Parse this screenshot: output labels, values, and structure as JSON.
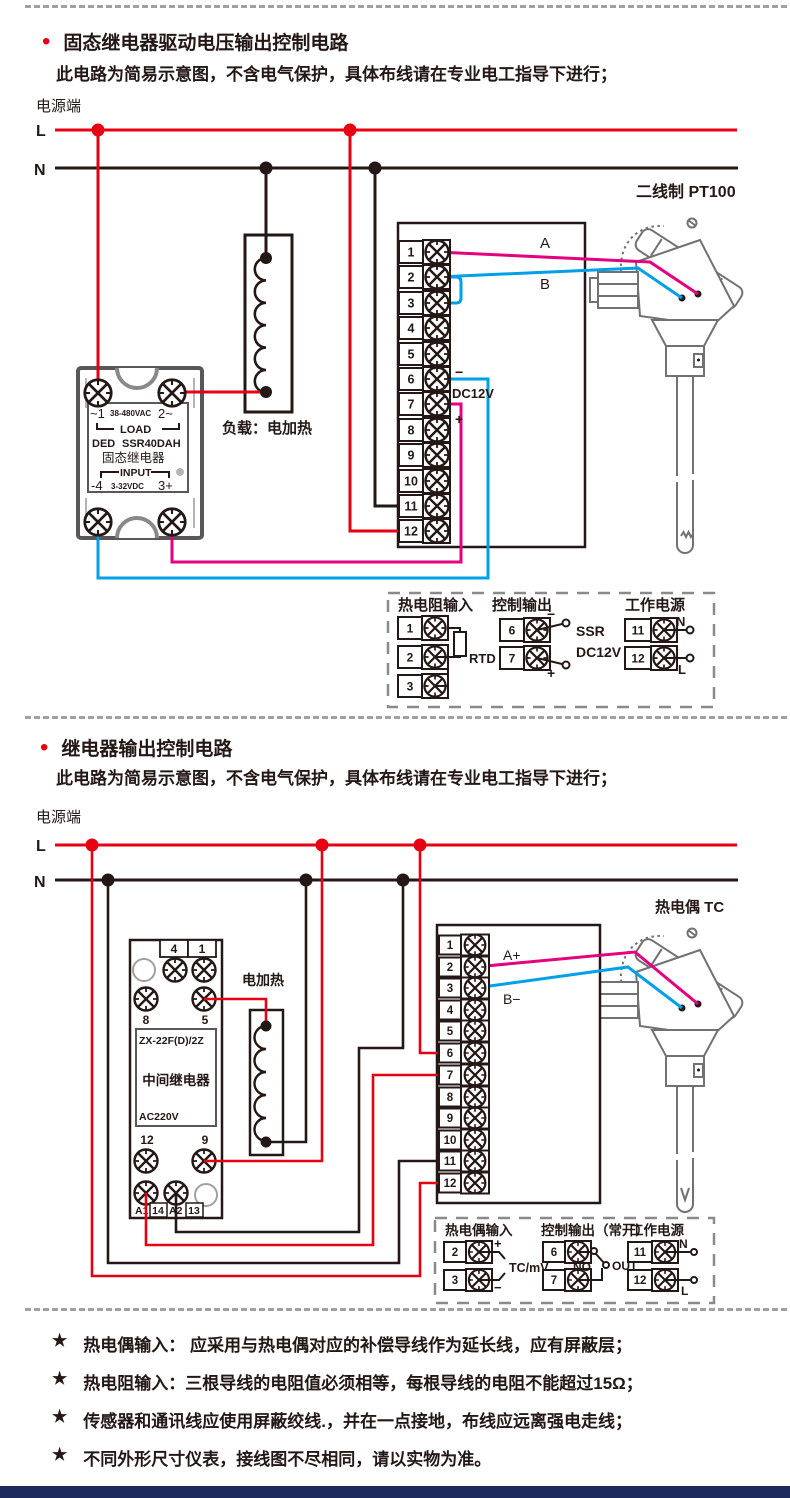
{
  "colors": {
    "wire_live": "#e60012",
    "wire_neutral": "#231815",
    "wire_blue": "#00a0e9",
    "wire_magenta": "#e4007f",
    "component_gray": "#727171",
    "footer_bar": "#1c2b5c"
  },
  "section1": {
    "bullet": "•",
    "title": "固态继电器驱动电压输出控制电路",
    "subtitle": "此电路为简易示意图，不含电气保护，具体布线请在专业电工指导下进行；",
    "power_label": "电源端",
    "live_label": "L",
    "neutral_label": "N",
    "ssr": {
      "pin1": "~1",
      "vac": "38-480VAC",
      "pin2": "2~",
      "load": "LOAD",
      "brand": "DED",
      "model": "SSR40DAH",
      "name": "固态继电器",
      "input": "INPUT",
      "pin4": "-4",
      "vdc": "3-32VDC",
      "pin3": "3+"
    },
    "load_label": "负载：电加热",
    "sensor_label": "二线制 PT100",
    "terminals": [
      "1",
      "2",
      "3",
      "4",
      "5",
      "6",
      "7",
      "8",
      "9",
      "10",
      "11",
      "12"
    ],
    "wire_a_label": "A",
    "wire_b_label": "B",
    "out_minus": "−",
    "out_dc": "DC12V",
    "out_plus": "+",
    "legend": {
      "rtd_title": "热电阻输入",
      "rtd_terminals": [
        "1",
        "2",
        "3"
      ],
      "rtd_label": "RTD",
      "out_title": "控制输出",
      "out_terminals": [
        "6",
        "7"
      ],
      "out_minus": "−",
      "out_plus": "+",
      "out_ssr": "SSR",
      "out_dc": "DC12V",
      "pwr_title": "工作电源",
      "pwr_terminals": [
        "11",
        "12"
      ],
      "pwr_n": "N",
      "pwr_l": "L"
    }
  },
  "section2": {
    "bullet": "•",
    "title": "继电器输出控制电路",
    "subtitle": "此电路为简易示意图，不含电气保护，具体布线请在专业电工指导下进行；",
    "power_label": "电源端",
    "live_label": "L",
    "neutral_label": "N",
    "relay": {
      "t4": "4",
      "t1": "1",
      "t8": "8",
      "t5": "5",
      "model": "ZX-22F(D)/2Z",
      "name": "中间继电器",
      "voltage": "AC220V",
      "t12": "12",
      "t9": "9",
      "a1": "A1",
      "p14": "14",
      "a2": "A2",
      "p13": "13"
    },
    "heater_label": "电加热",
    "sensor_label": "热电偶 TC",
    "terminals": [
      "1",
      "2",
      "3",
      "4",
      "5",
      "6",
      "7",
      "8",
      "9",
      "10",
      "11",
      "12"
    ],
    "wire_a_label": "A+",
    "wire_b_label": "B−",
    "legend": {
      "tc_title": "热电偶输入",
      "tc_terminals": [
        "2",
        "3"
      ],
      "tc_plus": "+",
      "tc_minus": "−",
      "tc_label": "TC/mV",
      "out_title": "控制输出（常开）",
      "out_terminals": [
        "6",
        "7"
      ],
      "out_no": "NO",
      "out_out": "OUT",
      "pwr_title": "工作电源",
      "pwr_terminals": [
        "11",
        "12"
      ],
      "pwr_n": "N",
      "pwr_l": "L"
    }
  },
  "notes": [
    {
      "star": "★",
      "text": "热电偶输入： 应采用与热电偶对应的补偿导线作为延长线，应有屏蔽层；"
    },
    {
      "star": "★",
      "text": "热电阻输入：三根导线的电阻值必须相等，每根导线的电阻不能超过15Ω；"
    },
    {
      "star": "★",
      "text": "传感器和通讯线应使用屏蔽绞线.，并在一点接地，布线应远离强电走线；"
    },
    {
      "star": "★",
      "text": "不同外形尺寸仪表，接线图不尽相同，请以实物为准。"
    }
  ]
}
